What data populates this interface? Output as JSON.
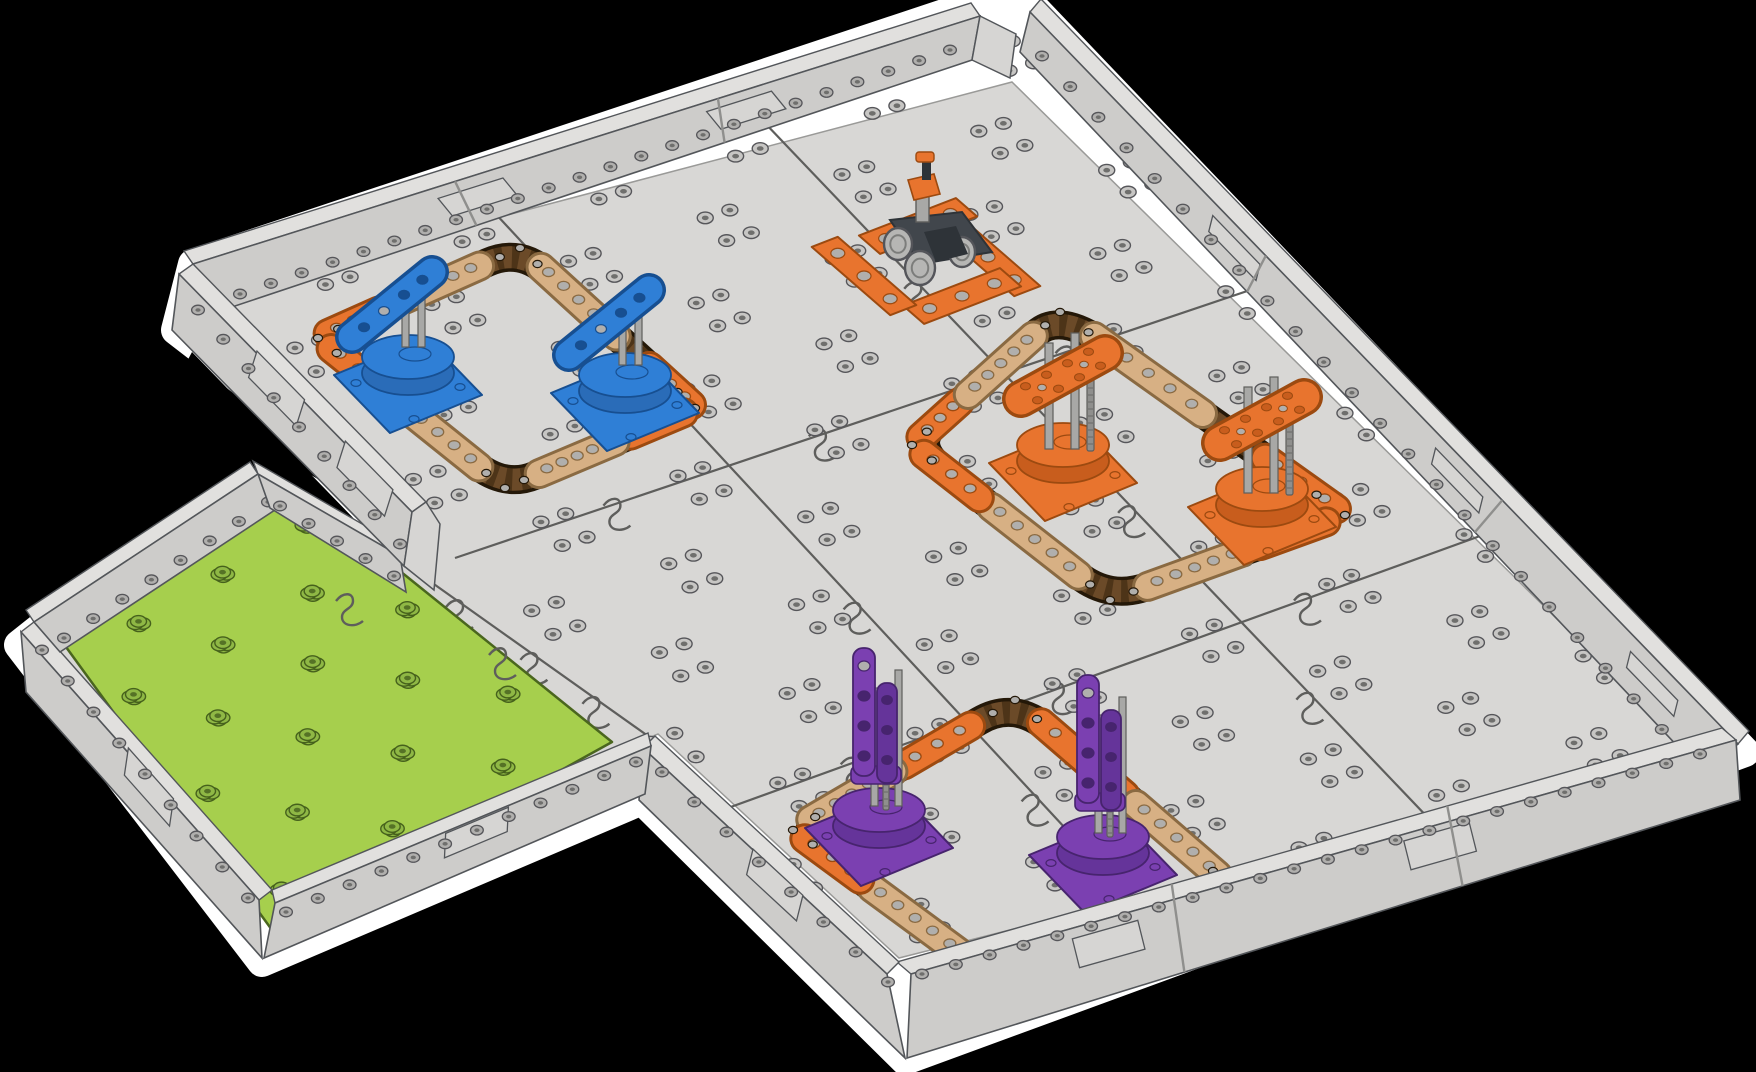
{
  "scene": {
    "kind": "isometric robotics field render",
    "background": "#000000",
    "outline": "#ffffff",
    "element_counts": {
      "blue_flag_pedestals": 2,
      "orange_tower_pedestals": 2,
      "purple_post_pedestals": 2,
      "robots": 1,
      "green_start_tiles": 1,
      "bordered_zones": 3
    }
  },
  "palette": {
    "floor": "#d8d7d5",
    "floor_line": "#5e5e5c",
    "edge": "#53565a",
    "wall_top": "#e1e0de",
    "wall_face": "#cdccca",
    "wall_face2": "#c3c2c0",
    "wall_cap": "#d6d5d3",
    "green": "#a6cf4d",
    "green_edge": "#4a661e",
    "dot": "#c7c6c4",
    "dot_edge": "#56565a",
    "dot_hole": "#6f6f6d",
    "gdot": "#8fb845",
    "gdot_edge": "#46611c",
    "gdot_hole": "#557226",
    "chain": "#4d3418",
    "chain_dark": "#241808",
    "chain_link": "#6b4a28",
    "tan": "#d7b084",
    "tan_edge": "#8a6a42",
    "orange": "#e8742e",
    "orange_edge": "#9c4a10",
    "orange_dark": "#c85d1d",
    "blue": "#2f7fd6",
    "blue_edge": "#174f91",
    "blue_dark": "#2a6cb8",
    "purple": "#7b40b1",
    "purple_edge": "#47246e",
    "purple_dark": "#65349a",
    "post": "#a8a8a6",
    "post_edge": "#5e5e5c",
    "rod": "#8f8f8d",
    "rod_line": "#696967",
    "pin": "#b0afad",
    "robot_body": "#41464c",
    "robot_dark": "#2e3338",
    "wheel": "#b6b6b4",
    "wheel_edge": "#54555"
  },
  "projection": {
    "N": [
      1015,
      15
    ],
    "E": [
      1730,
      740
    ],
    "S": [
      905,
      1058
    ],
    "W": [
      195,
      268
    ]
  },
  "silhouette": [
    [
      962,
      8
    ],
    [
      1034,
      8
    ],
    [
      1745,
      752
    ],
    [
      905,
      1060
    ],
    [
      642,
      800
    ],
    [
      262,
      962
    ],
    [
      19,
      645
    ],
    [
      254,
      458
    ],
    [
      396,
      544
    ],
    [
      404,
      590
    ],
    [
      434,
      590
    ],
    [
      412,
      512
    ],
    [
      176,
      330
    ],
    [
      193,
      264
    ]
  ],
  "dent": [
    [
      192,
      352
    ],
    [
      396,
      562
    ],
    [
      390,
      546
    ],
    [
      258,
      468
    ],
    [
      56,
      608
    ]
  ],
  "floor": [
    [
      1012,
      82
    ],
    [
      1696,
      756
    ],
    [
      899,
      958
    ],
    [
      658,
      734
    ],
    [
      272,
      890
    ],
    [
      34,
      622
    ],
    [
      258,
      474
    ],
    [
      400,
      556
    ],
    [
      426,
      502
    ],
    [
      215,
      292
    ]
  ],
  "green_tile": {
    "quad": [
      [
        302,
        492
      ],
      [
        612,
        742
      ],
      [
        272,
        930
      ],
      [
        58,
        636
      ]
    ],
    "grid": 6
  },
  "seams": [
    {
      "from": [
        742,
        99
      ],
      "to": [
        1455,
        846
      ]
    },
    {
      "from": [
        468,
        184
      ],
      "to": [
        1180,
        952
      ]
    },
    {
      "from": [
        1277,
        281
      ],
      "to": [
        455,
        558
      ]
    },
    {
      "from": [
        1516,
        523
      ],
      "to": [
        692,
        821
      ]
    },
    {
      "from": [
        400,
        560
      ],
      "to": [
        648,
        736
      ]
    }
  ],
  "walls": [
    {
      "name": "wall-nw",
      "ridge": [
        [
          193,
          264
        ],
        [
          980,
          16
        ]
      ],
      "top": [
        -9,
        -13
      ],
      "face": [
        [
          193,
          264
        ],
        [
          980,
          16
        ],
        [
          972,
          60
        ],
        [
          229,
          308
        ]
      ],
      "rivets": {
        "line": [
          [
            240,
            294
          ],
          [
            950,
            50
          ]
        ],
        "n": 24
      },
      "slots": [
        0.35,
        0.7
      ],
      "joints": [
        0.333,
        0.667
      ],
      "cap": [
        [
          980,
          16
        ],
        [
          1016,
          34
        ],
        [
          1010,
          78
        ],
        [
          972,
          60
        ]
      ]
    },
    {
      "name": "wall-ne",
      "ridge": [
        [
          1030,
          12
        ],
        [
          1738,
          744
        ]
      ],
      "top": [
        11,
        -13
      ],
      "face": [
        [
          1030,
          12
        ],
        [
          1738,
          744
        ],
        [
          1702,
          772
        ],
        [
          1020,
          52
        ]
      ],
      "rivets": {
        "line": [
          [
            1042,
            56
          ],
          [
            1690,
            760
          ]
        ],
        "n": 24
      },
      "slots": [
        0.3,
        0.62,
        0.9
      ],
      "joints": [
        0.333,
        0.667
      ]
    },
    {
      "name": "wall-se",
      "ridge": [
        [
          1722,
          728
        ],
        [
          897,
          962
        ]
      ],
      "top": [
        14,
        12
      ],
      "face": [
        [
          1736,
          740
        ],
        [
          911,
          974
        ],
        [
          907,
          1058
        ],
        [
          1740,
          800
        ]
      ],
      "rivets": {
        "line": [
          [
            1700,
            754
          ],
          [
            922,
            974
          ]
        ],
        "n": 24
      },
      "slots": [
        0.35,
        0.75
      ],
      "joints": [
        0.333,
        0.667
      ]
    },
    {
      "name": "wall-sw-purple",
      "ridge": [
        [
          655,
          736
        ],
        [
          899,
          962
        ]
      ],
      "top": [
        -12,
        12
      ],
      "face": [
        [
          643,
          748
        ],
        [
          887,
          974
        ],
        [
          905,
          1058
        ],
        [
          639,
          800
        ]
      ],
      "rivets": {
        "line": [
          [
            662,
            772
          ],
          [
            888,
            982
          ]
        ],
        "n": 8
      },
      "slots": [
        0.5
      ],
      "joints": []
    },
    {
      "name": "wall-green-se",
      "ridge": [
        [
          648,
          733
        ],
        [
          272,
          890
        ]
      ],
      "top": [
        3,
        13
      ],
      "face": [
        [
          651,
          746
        ],
        [
          275,
          903
        ],
        [
          264,
          958
        ],
        [
          645,
          794
        ]
      ],
      "rivets": {
        "line": [
          [
            636,
            762
          ],
          [
            286,
            912
          ]
        ],
        "n": 12
      },
      "slots": [
        0.45
      ],
      "joints": []
    },
    {
      "name": "wall-green-sw",
      "ridge": [
        [
          272,
          890
        ],
        [
          34,
          622
        ]
      ],
      "top": [
        -13,
        10
      ],
      "face": [
        [
          259,
          900
        ],
        [
          21,
          632
        ],
        [
          26,
          692
        ],
        [
          262,
          958
        ]
      ],
      "rivets": {
        "line": [
          [
            248,
            898
          ],
          [
            42,
            650
          ]
        ],
        "n": 9
      },
      "slots": [
        0.5
      ],
      "joints": []
    },
    {
      "name": "wall-green-ne-a",
      "ridge": [
        [
          34,
          622
        ],
        [
          258,
          474
        ]
      ],
      "top": [
        -8,
        -12
      ],
      "face": [
        [
          34,
          622
        ],
        [
          258,
          474
        ],
        [
          284,
          504
        ],
        [
          60,
          652
        ]
      ],
      "rivets": {
        "line": [
          [
            64,
            638
          ],
          [
            268,
            502
          ]
        ],
        "n": 8
      },
      "slots": [],
      "joints": []
    },
    {
      "name": "wall-green-ne-b",
      "ridge": [
        [
          258,
          474
        ],
        [
          400,
          556
        ]
      ],
      "top": [
        -5,
        -13
      ],
      "face": [
        [
          258,
          474
        ],
        [
          400,
          556
        ],
        [
          406,
          592
        ],
        [
          270,
          508
        ]
      ],
      "rivets": {
        "line": [
          [
            280,
            506
          ],
          [
            394,
            576
          ]
        ],
        "n": 5
      },
      "slots": [],
      "joints": []
    },
    {
      "name": "wall-sw-main",
      "ridge": [
        [
          193,
          264
        ],
        [
          426,
          502
        ]
      ],
      "top": [
        -14,
        10
      ],
      "face": [
        [
          179,
          274
        ],
        [
          412,
          512
        ],
        [
          404,
          566
        ],
        [
          172,
          330
        ]
      ],
      "rivets": {
        "line": [
          [
            198,
            310
          ],
          [
            400,
            544
          ]
        ],
        "n": 9
      },
      "slots": [
        0.4,
        0.78
      ],
      "joints": [],
      "cap": [
        [
          426,
          502
        ],
        [
          440,
          524
        ],
        [
          434,
          590
        ],
        [
          404,
          566
        ],
        [
          412,
          512
        ]
      ]
    }
  ],
  "zones": [
    {
      "name": "blue",
      "ring": [
        [
          520,
          248
        ],
        [
          695,
          408
        ],
        [
          505,
          488
        ],
        [
          318,
          338
        ]
      ],
      "beams": [
        {
          "e": 3,
          "f": [
            0.05,
            0.3
          ],
          "c": "orange",
          "h": 3
        },
        {
          "e": 3,
          "f": [
            0.36,
            0.8
          ],
          "c": "tan",
          "h": 5
        },
        {
          "e": 0,
          "f": [
            0.12,
            0.55
          ],
          "c": "tan",
          "h": 5
        },
        {
          "e": 0,
          "f": [
            0.74,
            0.98
          ],
          "c": "orange",
          "h": 3
        },
        {
          "e": 1,
          "f": [
            0.06,
            0.34
          ],
          "c": "orange",
          "h": 3
        },
        {
          "e": 1,
          "f": [
            0.42,
            0.82
          ],
          "c": "tan",
          "h": 5
        },
        {
          "e": 2,
          "f": [
            0.14,
            0.58
          ],
          "c": "tan",
          "h": 5
        },
        {
          "e": 2,
          "f": [
            0.64,
            0.93
          ],
          "c": "orange",
          "h": 3
        }
      ],
      "pedestals": [
        {
          "x": 408,
          "y": 385,
          "kind": "flag"
        },
        {
          "x": 625,
          "y": 403,
          "kind": "flag"
        }
      ]
    },
    {
      "name": "orange",
      "ring": [
        [
          1060,
          312
        ],
        [
          1345,
          515
        ],
        [
          1110,
          600
        ],
        [
          912,
          445
        ]
      ],
      "beams": [
        {
          "e": 3,
          "f": [
            0.06,
            0.32
          ],
          "c": "orange",
          "h": 3
        },
        {
          "e": 3,
          "f": [
            0.38,
            0.82
          ],
          "c": "tan",
          "h": 5
        },
        {
          "e": 0,
          "f": [
            0.12,
            0.5
          ],
          "c": "tan",
          "h": 5
        },
        {
          "e": 0,
          "f": [
            0.72,
            0.97
          ],
          "c": "orange",
          "h": 3
        },
        {
          "e": 1,
          "f": [
            0.08,
            0.36
          ],
          "c": "orange",
          "h": 3
        },
        {
          "e": 1,
          "f": [
            0.44,
            0.84
          ],
          "c": "tan",
          "h": 5
        },
        {
          "e": 2,
          "f": [
            0.16,
            0.6
          ],
          "c": "tan",
          "h": 5
        },
        {
          "e": 2,
          "f": [
            0.66,
            0.94
          ],
          "c": "orange",
          "h": 3
        }
      ],
      "pedestals": [
        {
          "x": 1063,
          "y": 473,
          "kind": "tower"
        },
        {
          "x": 1262,
          "y": 517,
          "kind": "tower"
        }
      ]
    },
    {
      "name": "purple",
      "ring": [
        [
          1015,
          700
        ],
        [
          1235,
          890
        ],
        [
          990,
          975
        ],
        [
          793,
          830
        ]
      ],
      "beams": [
        {
          "e": 3,
          "f": [
            0.5,
            0.8
          ],
          "c": "orange",
          "h": 3
        },
        {
          "e": 3,
          "f": [
            0.08,
            0.45
          ],
          "c": "tan",
          "h": 5
        },
        {
          "e": 0,
          "f": [
            0.12,
            0.5
          ],
          "c": "orange",
          "h": 3
        },
        {
          "e": 0,
          "f": [
            0.55,
            0.92
          ],
          "c": "tan",
          "h": 5
        },
        {
          "e": 1,
          "f": [
            0.08,
            0.36
          ],
          "c": "orange",
          "h": 3
        },
        {
          "e": 1,
          "f": [
            0.44,
            0.84
          ],
          "c": "tan",
          "h": 5
        },
        {
          "e": 2,
          "f": [
            0.16,
            0.6
          ],
          "c": "tan",
          "h": 5
        },
        {
          "e": 2,
          "f": [
            0.66,
            0.94
          ],
          "c": "orange",
          "h": 3
        }
      ],
      "pedestals": [
        {
          "x": 879,
          "y": 838,
          "kind": "post"
        },
        {
          "x": 1103,
          "y": 865,
          "kind": "post"
        }
      ]
    }
  ],
  "platform": {
    "center": [
      928,
      258
    ],
    "plates": [
      {
        "c": [
          918,
          226
        ],
        "axis": "v"
      },
      {
        "c": [
          988,
          257
        ],
        "axis": "u"
      },
      {
        "c": [
          962,
          296
        ],
        "axis": "v"
      },
      {
        "c": [
          864,
          276
        ],
        "axis": "u"
      }
    ],
    "half_len": 52,
    "half_w": 14,
    "pins": 3
  },
  "robot": {
    "center": [
      930,
      246
    ]
  },
  "dots": {
    "step": 0.25,
    "offset": 0.125,
    "du": 0.045,
    "dv": 0.045,
    "max_y": 945
  }
}
